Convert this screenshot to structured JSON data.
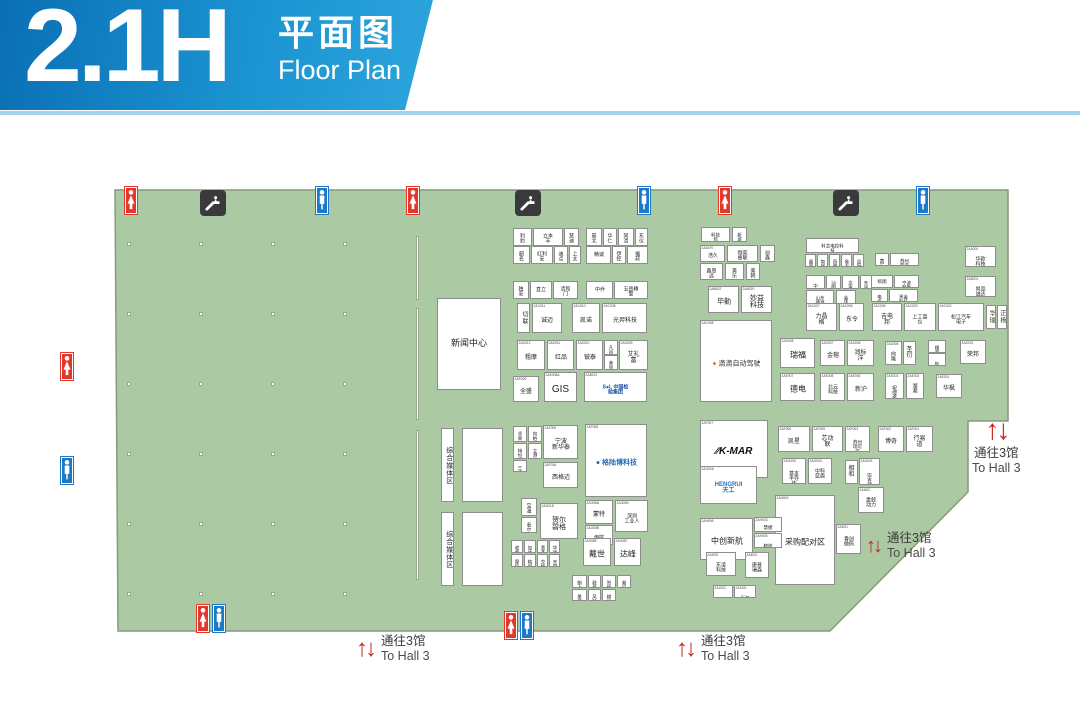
{
  "header": {
    "hall": "2.1H",
    "title_cn": "平面图",
    "title_en": "Floor Plan"
  },
  "hall": {
    "fill": "#abc9a2",
    "border": "#87997f",
    "polygon": "115,190 1008,190 1008,421 968,421 968,492 830,631 118,631"
  },
  "pillars": {
    "cols": [
      127,
      199,
      271,
      343
    ],
    "rows": [
      242,
      312,
      382,
      452,
      522,
      592
    ]
  },
  "walls": [
    [
      416,
      236,
      64
    ],
    [
      416,
      308,
      112
    ],
    [
      416,
      430,
      150
    ]
  ],
  "icons": [
    {
      "t": "wc_f",
      "x": 124,
      "y": 186
    },
    {
      "t": "esc",
      "x": 200,
      "y": 190
    },
    {
      "t": "wc_m",
      "x": 315,
      "y": 186
    },
    {
      "t": "wc_f",
      "x": 406,
      "y": 186
    },
    {
      "t": "esc",
      "x": 515,
      "y": 190
    },
    {
      "t": "wc_m",
      "x": 637,
      "y": 186
    },
    {
      "t": "wc_f",
      "x": 718,
      "y": 186
    },
    {
      "t": "esc",
      "x": 833,
      "y": 190
    },
    {
      "t": "wc_m",
      "x": 916,
      "y": 186
    },
    {
      "t": "wc_f",
      "x": 60,
      "y": 352
    },
    {
      "t": "wc_m",
      "x": 60,
      "y": 456
    },
    {
      "t": "wc_f",
      "x": 196,
      "y": 604
    },
    {
      "t": "wc_m",
      "x": 212,
      "y": 604
    },
    {
      "t": "wc_f",
      "x": 504,
      "y": 611
    },
    {
      "t": "wc_m",
      "x": 520,
      "y": 611
    }
  ],
  "signs": [
    {
      "x": 356,
      "y": 634,
      "cn": "通往3馆",
      "en": "To Hall 3",
      "mode": "row",
      "as": 24
    },
    {
      "x": 676,
      "y": 634,
      "cn": "通往3馆",
      "en": "To Hall 3",
      "mode": "row",
      "as": 24
    },
    {
      "x": 866,
      "y": 531,
      "cn": "通往3馆",
      "en": "To Hall 3",
      "mode": "row",
      "as": 20
    },
    {
      "x": 972,
      "y": 416,
      "cn": "通往3馆",
      "en": "To Hall 3",
      "mode": "stack",
      "as": 28
    }
  ],
  "booths": [
    {
      "x": 437,
      "y": 298,
      "w": 64,
      "h": 92,
      "c": "",
      "n": "新闻中心",
      "fs": 9,
      "id": "news-center"
    },
    {
      "x": 441,
      "y": 428,
      "w": 13,
      "h": 74,
      "c": "",
      "n": "综合媒体区",
      "fs": 7,
      "vert": true,
      "id": "media-zone-1"
    },
    {
      "x": 462,
      "y": 428,
      "w": 41,
      "h": 74,
      "c": "",
      "n": ""
    },
    {
      "x": 441,
      "y": 512,
      "w": 13,
      "h": 74,
      "c": "",
      "n": "综合媒体区",
      "fs": 7,
      "vert": true,
      "id": "media-zone-2"
    },
    {
      "x": 462,
      "y": 512,
      "w": 41,
      "h": 74,
      "c": "",
      "n": ""
    },
    {
      "x": 513,
      "y": 228,
      "w": 19,
      "h": 18,
      "c": "",
      "n": "利豹"
    },
    {
      "x": 533,
      "y": 228,
      "w": 30,
      "h": 18,
      "c": "",
      "n": "立本丰"
    },
    {
      "x": 564,
      "y": 228,
      "w": 15,
      "h": 18,
      "c": "",
      "n": "慧迪"
    },
    {
      "x": 513,
      "y": 246,
      "w": 17,
      "h": 18,
      "c": "",
      "n": "韶名"
    },
    {
      "x": 531,
      "y": 246,
      "w": 22,
      "h": 18,
      "c": "",
      "n": "红利安"
    },
    {
      "x": 554,
      "y": 246,
      "w": 14,
      "h": 18,
      "c": "",
      "n": "迪点"
    },
    {
      "x": 569,
      "y": 246,
      "w": 12,
      "h": 18,
      "c": "",
      "n": "上太"
    },
    {
      "x": 586,
      "y": 228,
      "w": 16,
      "h": 18,
      "c": "",
      "n": "晨北"
    },
    {
      "x": 603,
      "y": 228,
      "w": 14,
      "h": 18,
      "c": "",
      "n": "华仁"
    },
    {
      "x": 618,
      "y": 228,
      "w": 16,
      "h": 18,
      "c": "",
      "n": "同清"
    },
    {
      "x": 635,
      "y": 228,
      "w": 13,
      "h": 18,
      "c": "",
      "n": "东仪"
    },
    {
      "x": 586,
      "y": 246,
      "w": 25,
      "h": 18,
      "c": "",
      "n": "精诚"
    },
    {
      "x": 612,
      "y": 246,
      "w": 14,
      "h": 18,
      "c": "",
      "n": "伊控"
    },
    {
      "x": 627,
      "y": 246,
      "w": 21,
      "h": 18,
      "c": "",
      "n": "福邦"
    },
    {
      "x": 513,
      "y": 281,
      "w": 16,
      "h": 18,
      "c": "",
      "n": "独安"
    },
    {
      "x": 530,
      "y": 281,
      "w": 22,
      "h": 18,
      "c": "",
      "n": "直立"
    },
    {
      "x": 553,
      "y": 281,
      "w": 25,
      "h": 18,
      "c": "",
      "n": "清和门"
    },
    {
      "x": 586,
      "y": 281,
      "w": 27,
      "h": 18,
      "c": "",
      "n": "中乔"
    },
    {
      "x": 614,
      "y": 281,
      "w": 34,
      "h": 18,
      "c": "",
      "n": "五岳精警"
    },
    {
      "x": 517,
      "y": 303,
      "w": 13,
      "h": 30,
      "c": "",
      "n": "切联",
      "vert": true
    },
    {
      "x": 532,
      "y": 303,
      "w": 30,
      "h": 30,
      "c": "2AC011",
      "n": "诚迈"
    },
    {
      "x": 572,
      "y": 303,
      "w": 28,
      "h": 30,
      "c": "2AC010",
      "n": "凯诺"
    },
    {
      "x": 602,
      "y": 303,
      "w": 45,
      "h": 30,
      "c": "2AC008",
      "n": "光羿科技"
    },
    {
      "x": 517,
      "y": 340,
      "w": 28,
      "h": 30,
      "c": "2AD012",
      "n": "粗摩"
    },
    {
      "x": 547,
      "y": 340,
      "w": 27,
      "h": 30,
      "c": "2AD011",
      "n": "红品"
    },
    {
      "x": 576,
      "y": 340,
      "w": 27,
      "h": 30,
      "c": "2AD010",
      "n": "铍泰"
    },
    {
      "x": 604,
      "y": 340,
      "w": 14,
      "h": 15,
      "c": "",
      "n": "凡益"
    },
    {
      "x": 604,
      "y": 355,
      "w": 14,
      "h": 15,
      "c": "",
      "n": "美固"
    },
    {
      "x": 619,
      "y": 340,
      "w": 29,
      "h": 30,
      "c": "2AD009",
      "n": "艾礼富"
    },
    {
      "x": 513,
      "y": 376,
      "w": 26,
      "h": 26,
      "c": "2AE009",
      "n": "全盛"
    },
    {
      "x": 544,
      "y": 372,
      "w": 33,
      "h": 30,
      "c": "2AE008A",
      "n": "GIS",
      "fs": 10
    },
    {
      "x": 584,
      "y": 372,
      "w": 63,
      "h": 30,
      "c": "2AB021",
      "n": "S●L 中国检验集团",
      "logo": "sol",
      "fs": 5
    },
    {
      "x": 513,
      "y": 426,
      "w": 14,
      "h": 16,
      "c": "",
      "n": "坚果"
    },
    {
      "x": 528,
      "y": 426,
      "w": 14,
      "h": 16,
      "c": "",
      "n": "向柏"
    },
    {
      "x": 513,
      "y": 443,
      "w": 14,
      "h": 16,
      "c": "",
      "n": "特恒"
    },
    {
      "x": 528,
      "y": 443,
      "w": 14,
      "h": 16,
      "c": "",
      "n": "立港"
    },
    {
      "x": 513,
      "y": 460,
      "w": 14,
      "h": 12,
      "c": "",
      "n": "三清"
    },
    {
      "x": 543,
      "y": 425,
      "w": 35,
      "h": 34,
      "c": "2AF009",
      "n": "宁波\n新华泰",
      "fs": 6
    },
    {
      "x": 585,
      "y": 424,
      "w": 62,
      "h": 73,
      "c": "2AF008",
      "n": "● 格陆博科技",
      "logo": "glb",
      "fs": 7
    },
    {
      "x": 543,
      "y": 462,
      "w": 35,
      "h": 26,
      "c": "2AF016",
      "n": "西格迈"
    },
    {
      "x": 521,
      "y": 498,
      "w": 16,
      "h": 18,
      "c": "",
      "n": "宝温"
    },
    {
      "x": 521,
      "y": 517,
      "w": 16,
      "h": 16,
      "c": "",
      "n": "看尔"
    },
    {
      "x": 540,
      "y": 503,
      "w": 38,
      "h": 36,
      "c": "2AG018",
      "n": "贺尔\n碧格",
      "fs": 7
    },
    {
      "x": 585,
      "y": 500,
      "w": 28,
      "h": 24,
      "c": "2AG08A",
      "n": "蒙特"
    },
    {
      "x": 615,
      "y": 500,
      "w": 33,
      "h": 32,
      "c": "2AG080",
      "n": "深圳\n工业人",
      "fs": 5
    },
    {
      "x": 585,
      "y": 525,
      "w": 28,
      "h": 20,
      "c": "2AG08B",
      "n": "伊控"
    },
    {
      "x": 511,
      "y": 540,
      "w": 12,
      "h": 13,
      "c": "",
      "n": "收葛"
    },
    {
      "x": 524,
      "y": 540,
      "w": 12,
      "h": 13,
      "c": "",
      "n": "加达"
    },
    {
      "x": 537,
      "y": 540,
      "w": 11,
      "h": 13,
      "c": "",
      "n": "意杰"
    },
    {
      "x": 549,
      "y": 540,
      "w": 11,
      "h": 13,
      "c": "",
      "n": "华闵"
    },
    {
      "x": 511,
      "y": 554,
      "w": 12,
      "h": 13,
      "c": "",
      "n": "摩校"
    },
    {
      "x": 524,
      "y": 554,
      "w": 12,
      "h": 13,
      "c": "",
      "n": "梅里"
    },
    {
      "x": 537,
      "y": 554,
      "w": 11,
      "h": 13,
      "c": "",
      "n": "交换"
    },
    {
      "x": 549,
      "y": 554,
      "w": 11,
      "h": 13,
      "c": "",
      "n": "天琴"
    },
    {
      "x": 583,
      "y": 538,
      "w": 28,
      "h": 28,
      "c": "2AH085",
      "n": "戴世",
      "fs": 8
    },
    {
      "x": 614,
      "y": 538,
      "w": 27,
      "h": 28,
      "c": "2AH087",
      "n": "达峰",
      "fs": 8
    },
    {
      "x": 572,
      "y": 575,
      "w": 15,
      "h": 13,
      "c": "",
      "n": "朝上"
    },
    {
      "x": 588,
      "y": 575,
      "w": 13,
      "h": 13,
      "c": "",
      "n": "懿扬"
    },
    {
      "x": 602,
      "y": 575,
      "w": 14,
      "h": 13,
      "c": "",
      "n": "贺扬"
    },
    {
      "x": 617,
      "y": 575,
      "w": 14,
      "h": 13,
      "c": "",
      "n": "湘设"
    },
    {
      "x": 572,
      "y": 589,
      "w": 15,
      "h": 12,
      "c": "",
      "n": "墨特"
    },
    {
      "x": 588,
      "y": 589,
      "w": 13,
      "h": 12,
      "c": "",
      "n": "风铃"
    },
    {
      "x": 602,
      "y": 589,
      "w": 14,
      "h": 12,
      "c": "",
      "n": "模派"
    },
    {
      "x": 701,
      "y": 227,
      "w": 29,
      "h": 15,
      "c": "",
      "n": "科技邦"
    },
    {
      "x": 732,
      "y": 227,
      "w": 15,
      "h": 15,
      "c": "",
      "n": "新城"
    },
    {
      "x": 700,
      "y": 245,
      "w": 25,
      "h": 17,
      "c": "2AA070",
      "n": "浩久"
    },
    {
      "x": 727,
      "y": 245,
      "w": 31,
      "h": 17,
      "c": "",
      "n": "恒奕睿联"
    },
    {
      "x": 760,
      "y": 245,
      "w": 15,
      "h": 17,
      "c": "",
      "n": "创鑫"
    },
    {
      "x": 700,
      "y": 263,
      "w": 23,
      "h": 17,
      "c": "",
      "n": "鑫思远"
    },
    {
      "x": 725,
      "y": 263,
      "w": 19,
      "h": 17,
      "c": "",
      "n": "美乐"
    },
    {
      "x": 746,
      "y": 263,
      "w": 14,
      "h": 17,
      "c": "",
      "n": "美韩"
    },
    {
      "x": 708,
      "y": 286,
      "w": 31,
      "h": 27,
      "c": "2AB022",
      "n": "毕勤",
      "fs": 7
    },
    {
      "x": 741,
      "y": 286,
      "w": 31,
      "h": 27,
      "c": "2AB020",
      "n": "妙益\n科技",
      "fs": 7
    },
    {
      "x": 806,
      "y": 238,
      "w": 53,
      "h": 15,
      "c": "",
      "n": "科芯电控科技"
    },
    {
      "x": 805,
      "y": 254,
      "w": 11,
      "h": 13,
      "c": "",
      "n": "置富"
    },
    {
      "x": 817,
      "y": 254,
      "w": 11,
      "h": 13,
      "c": "",
      "n": "智新"
    },
    {
      "x": 829,
      "y": 254,
      "w": 11,
      "h": 13,
      "c": "",
      "n": "燕麟"
    },
    {
      "x": 841,
      "y": 254,
      "w": 11,
      "h": 13,
      "c": "",
      "n": "象泰"
    },
    {
      "x": 853,
      "y": 254,
      "w": 11,
      "h": 13,
      "c": "",
      "n": "显时"
    },
    {
      "x": 875,
      "y": 253,
      "w": 14,
      "h": 13,
      "c": "",
      "n": "茜石"
    },
    {
      "x": 890,
      "y": 253,
      "w": 29,
      "h": 13,
      "c": "",
      "n": "苏州宏海"
    },
    {
      "x": 806,
      "y": 275,
      "w": 19,
      "h": 14,
      "c": "",
      "n": "中慧睿"
    },
    {
      "x": 826,
      "y": 275,
      "w": 15,
      "h": 14,
      "c": "",
      "n": "汕明"
    },
    {
      "x": 842,
      "y": 275,
      "w": 17,
      "h": 14,
      "c": "",
      "n": "念垂"
    },
    {
      "x": 860,
      "y": 275,
      "w": 12,
      "h": 14,
      "c": "",
      "n": "天迪"
    },
    {
      "x": 806,
      "y": 290,
      "w": 28,
      "h": 14,
      "c": "",
      "n": "山东德源"
    },
    {
      "x": 836,
      "y": 290,
      "w": 20,
      "h": 14,
      "c": "",
      "n": "金环"
    },
    {
      "x": 871,
      "y": 275,
      "w": 22,
      "h": 13,
      "c": "",
      "n": "缤翔"
    },
    {
      "x": 894,
      "y": 275,
      "w": 25,
      "h": 13,
      "c": "",
      "n": "宁波智胜"
    },
    {
      "x": 871,
      "y": 289,
      "w": 17,
      "h": 13,
      "c": "",
      "n": "电亟"
    },
    {
      "x": 889,
      "y": 289,
      "w": 29,
      "h": 13,
      "c": "",
      "n": "黑金科技"
    },
    {
      "x": 965,
      "y": 246,
      "w": 31,
      "h": 21,
      "c": "2AA001",
      "n": "华欧科技",
      "fs": 5
    },
    {
      "x": 965,
      "y": 276,
      "w": 31,
      "h": 21,
      "c": "2AB001",
      "n": "尚品诚达",
      "fs": 5
    },
    {
      "x": 806,
      "y": 303,
      "w": 31,
      "h": 28,
      "c": "2AC007",
      "n": "力晶格"
    },
    {
      "x": 839,
      "y": 303,
      "w": 25,
      "h": 28,
      "c": "2AC006",
      "n": "东令"
    },
    {
      "x": 872,
      "y": 303,
      "w": 30,
      "h": 28,
      "c": "2AC005",
      "n": "吉电邦"
    },
    {
      "x": 904,
      "y": 303,
      "w": 32,
      "h": 28,
      "c": "2AC003",
      "n": "上工富仪",
      "fs": 5
    },
    {
      "x": 938,
      "y": 303,
      "w": 46,
      "h": 28,
      "c": "2AC002",
      "n": "松江汽车电子",
      "fs": 5
    },
    {
      "x": 986,
      "y": 305,
      "w": 10,
      "h": 24,
      "c": "",
      "n": "华瑞",
      "vert": true
    },
    {
      "x": 997,
      "y": 305,
      "w": 10,
      "h": 24,
      "c": "",
      "n": "正杨",
      "vert": true
    },
    {
      "x": 700,
      "y": 320,
      "w": 72,
      "h": 82,
      "c": "2AC008",
      "n": "● 滴滴自动驾驶",
      "logo": "didi",
      "fs": 7
    },
    {
      "x": 780,
      "y": 338,
      "w": 35,
      "h": 30,
      "c": "2AD008",
      "n": "瑞福",
      "fs": 8
    },
    {
      "x": 820,
      "y": 340,
      "w": 25,
      "h": 26,
      "c": "2AD007",
      "n": "金榕"
    },
    {
      "x": 847,
      "y": 340,
      "w": 27,
      "h": 26,
      "c": "2AD006",
      "n": "润标洋"
    },
    {
      "x": 885,
      "y": 341,
      "w": 17,
      "h": 24,
      "c": "2AD005",
      "n": "向隆",
      "fs": 5
    },
    {
      "x": 903,
      "y": 341,
      "w": 13,
      "h": 24,
      "c": "",
      "n": "圣衍"
    },
    {
      "x": 928,
      "y": 340,
      "w": 18,
      "h": 13,
      "c": "",
      "n": "穗邦"
    },
    {
      "x": 928,
      "y": 353,
      "w": 18,
      "h": 13,
      "c": "",
      "n": "航力达"
    },
    {
      "x": 960,
      "y": 340,
      "w": 26,
      "h": 24,
      "c": "2AD001",
      "n": "荣邦"
    },
    {
      "x": 780,
      "y": 373,
      "w": 35,
      "h": 28,
      "c": "2AE007",
      "n": "德电",
      "fs": 8
    },
    {
      "x": 820,
      "y": 373,
      "w": 25,
      "h": 28,
      "c": "2AE008",
      "n": "北云\n科技",
      "fs": 5
    },
    {
      "x": 847,
      "y": 373,
      "w": 27,
      "h": 28,
      "c": "2AE005",
      "n": "新沪"
    },
    {
      "x": 885,
      "y": 373,
      "w": 19,
      "h": 26,
      "c": "2AE003",
      "n": "祝理金",
      "fs": 5
    },
    {
      "x": 906,
      "y": 373,
      "w": 18,
      "h": 26,
      "c": "2AE002",
      "n": "湖湘",
      "fs": 5
    },
    {
      "x": 936,
      "y": 374,
      "w": 26,
      "h": 24,
      "c": "2AE001",
      "n": "华枫"
    },
    {
      "x": 700,
      "y": 420,
      "w": 68,
      "h": 58,
      "c": "2AF007",
      "n": "∕∕K-MAR",
      "logo": "kmar",
      "fs": 10
    },
    {
      "x": 778,
      "y": 426,
      "w": 32,
      "h": 26,
      "c": "2AF006",
      "n": "凯星"
    },
    {
      "x": 812,
      "y": 426,
      "w": 31,
      "h": 26,
      "c": "2AF005",
      "n": "芯动联"
    },
    {
      "x": 845,
      "y": 426,
      "w": 25,
      "h": 26,
      "c": "2AF003",
      "n": "苏州\n瑞可达",
      "fs": 4.5
    },
    {
      "x": 878,
      "y": 426,
      "w": 26,
      "h": 26,
      "c": "2AF002",
      "n": "博奇"
    },
    {
      "x": 906,
      "y": 426,
      "w": 27,
      "h": 26,
      "c": "2AF001",
      "n": "行易道"
    },
    {
      "x": 700,
      "y": 466,
      "w": 57,
      "h": 38,
      "c": "2AG006",
      "n": "HENGRUI天工",
      "logo": "hen",
      "fs": 6
    },
    {
      "x": 782,
      "y": 458,
      "w": 24,
      "h": 26,
      "c": "2AG005",
      "n": "基本\n半导体",
      "fs": 5
    },
    {
      "x": 808,
      "y": 458,
      "w": 24,
      "h": 26,
      "c": "2AG003",
      "n": "中科\n蓝盾",
      "fs": 5
    },
    {
      "x": 845,
      "y": 460,
      "w": 13,
      "h": 24,
      "c": "",
      "n": "相和"
    },
    {
      "x": 859,
      "y": 458,
      "w": 21,
      "h": 27,
      "c": "2AG001",
      "n": "毕克\n凯乐",
      "fs": 5
    },
    {
      "x": 858,
      "y": 487,
      "w": 26,
      "h": 26,
      "c": "2AI002",
      "n": "盘毂\n动力",
      "fs": 5
    },
    {
      "x": 836,
      "y": 524,
      "w": 25,
      "h": 30,
      "c": "2AI001",
      "n": "香创\n微码",
      "fs": 5
    },
    {
      "x": 775,
      "y": 495,
      "w": 60,
      "h": 90,
      "c": "2AH002",
      "n": "采购配对区",
      "fs": 8,
      "id": "procurement-matching-zone"
    },
    {
      "x": 700,
      "y": 518,
      "w": 53,
      "h": 42,
      "c": "2AH006",
      "n": "中创新航",
      "fs": 8
    },
    {
      "x": 754,
      "y": 517,
      "w": 28,
      "h": 15,
      "c": "2AH003",
      "n": "慧捷"
    },
    {
      "x": 754,
      "y": 533,
      "w": 28,
      "h": 15,
      "c": "2AH005",
      "n": "精锐特"
    },
    {
      "x": 706,
      "y": 552,
      "w": 30,
      "h": 24,
      "c": "2AI005",
      "n": "东凌科技",
      "fs": 5
    },
    {
      "x": 745,
      "y": 552,
      "w": 24,
      "h": 26,
      "c": "2AI003",
      "n": "康普\n瑞森",
      "fs": 5
    },
    {
      "x": 713,
      "y": 585,
      "w": 20,
      "h": 13,
      "c": "2AJ002",
      "n": "奥特伦"
    },
    {
      "x": 734,
      "y": 585,
      "w": 22,
      "h": 13,
      "c": "2AJ001",
      "n": "迈尔瑞拓"
    }
  ]
}
